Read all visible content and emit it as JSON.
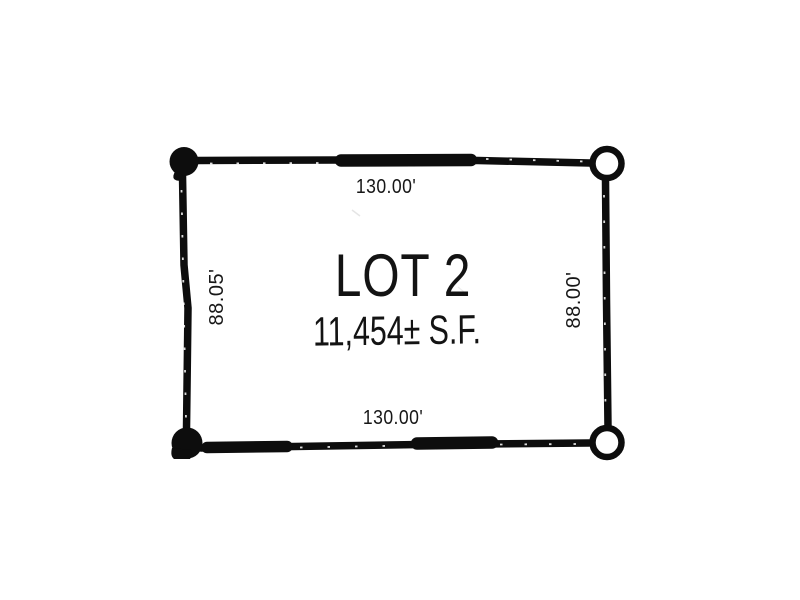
{
  "diagram": {
    "type": "survey-plat",
    "lot_label": "LOT 2",
    "area_label": "11,454± S.F.",
    "dimensions": {
      "top": "130.00'",
      "bottom": "130.00'",
      "left": "88.05'",
      "right": "88.00'"
    },
    "corner_markers": {
      "top_left": "filled-circle",
      "top_right": "open-circle",
      "bottom_left": "filled-circle",
      "bottom_right": "open-circle"
    },
    "colors": {
      "ink": "#0d0d0d",
      "background": "#ffffff"
    }
  }
}
